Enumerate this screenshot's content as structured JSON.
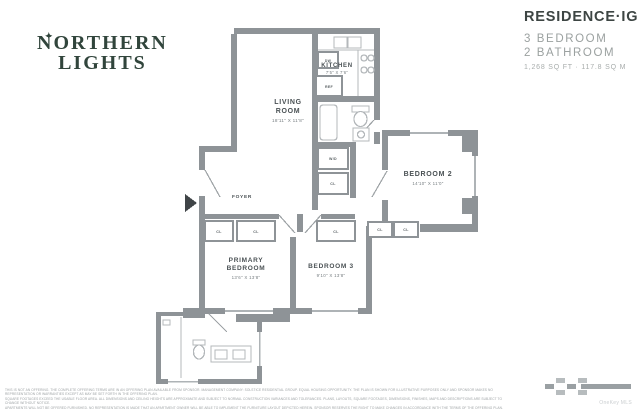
{
  "header": {
    "logo": {
      "star": "✦",
      "line1": "NORTHERN",
      "line2": "LIGHTS"
    },
    "residence": {
      "title": "RESIDENCE·IG",
      "bedrooms": "3 BEDROOM",
      "bathrooms": "2 BATHROOM",
      "area": "1,268 SQ FT · 117.8 SQ M"
    }
  },
  "floorplan": {
    "rooms": {
      "living": {
        "line1": "LIVING",
        "line2": "ROOM",
        "dims": "18'11\" X 11'8\""
      },
      "kitchen": {
        "name": "KITCHEN",
        "dims": "7'5\" X 7'6\""
      },
      "bedroom2": {
        "name": "BEDROOM 2",
        "dims": "14'10\" X 11'0\""
      },
      "bedroom3": {
        "name": "BEDROOM 3",
        "dims": "9'10\" X 13'8\""
      },
      "primary": {
        "line1": "PRIMARY",
        "line2": "BEDROOM",
        "dims": "13'6\" X 13'8\""
      },
      "foyer": {
        "name": "FOYER"
      }
    },
    "labels": {
      "closet": "CL",
      "washer_dryer": "W/D",
      "dishwasher": "DW",
      "refrigerator": "REF"
    },
    "colors": {
      "wall_gray": "#8e9397",
      "logo_green": "#31453c",
      "title_dark": "#3d4543",
      "muted_gray": "#9ba1a0"
    }
  },
  "footer": {
    "disclaimer_line1": "THIS IS NOT AN OFFERING. THE COMPLETE OFFERING TERMS ARE IN AN OFFERING PLAN AVAILABLE FROM SPONSOR. MANAGEMENT COMPANY: SOLSTICE RESIDENTIAL GROUP. EQUAL HOUSING OPPORTUNITY. THE PLAN IS SHOWN FOR ILLUSTRATIVE PURPOSES ONLY AND SPONSOR MAKES NO REPRESENTATION OR WARRANTIES EXCEPT AS MAY BE SET FORTH IN THE OFFERING PLAN.",
    "disclaimer_line2": "SQUARE FOOTAGES EXCEED THE USABLE FLOOR AREA. ALL DIMENSIONS AND CEILING HEIGHTS ARE APPROXIMATE AND SUBJECT TO NORMAL CONSTRUCTION VARIANCES AND TOLERANCES. PLANS, LAYOUTS, SQUARE FOOTAGES, DIMENSIONS, FINISHES, MAPS AND DESCRIPTIONS ARE SUBJECT TO CHANGE WITHOUT NOTICE.",
    "disclaimer_line3": "APARTMENTS WILL NOT BE OFFERED FURNISHED. NO REPRESENTATION IS MADE THAT AN APARTMENT OWNER WILL BE ABLE TO IMPLEMENT THE FURNITURE LAYOUT DEPICTED HEREIN. SPONSOR RESERVES THE RIGHT TO MAKE CHANGES IN ACCORDANCE WITH THE TERMS OF THE OFFERING PLAN.",
    "watermark": "OneKey MLS"
  }
}
